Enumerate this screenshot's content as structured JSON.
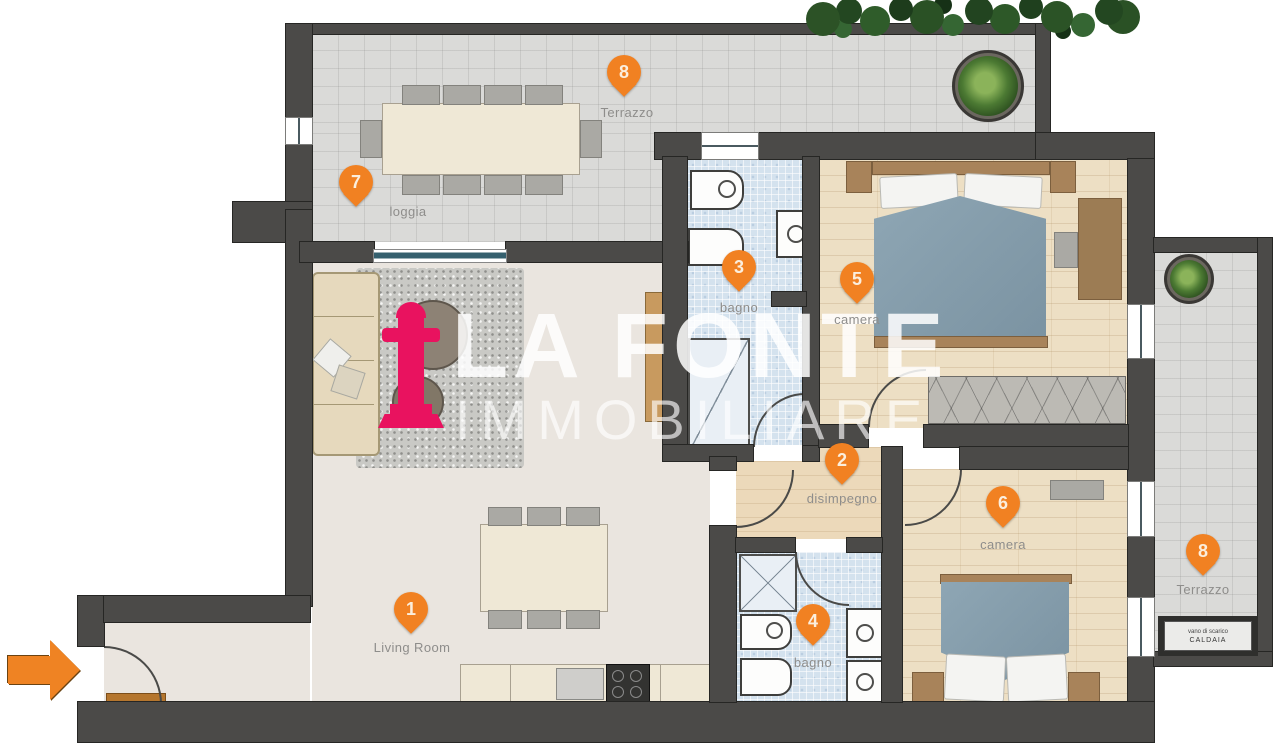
{
  "plan": {
    "brand": {
      "line1": "LA FONTE",
      "line2": "IMMOBILIARE"
    },
    "markers": [
      {
        "number": "1",
        "label": "Living Room"
      },
      {
        "number": "2",
        "label": "disimpegno"
      },
      {
        "number": "3",
        "label": "bagno"
      },
      {
        "number": "4",
        "label": "bagno"
      },
      {
        "number": "5",
        "label": "camera"
      },
      {
        "number": "6",
        "label": "camera"
      },
      {
        "number": "7",
        "label": "loggia"
      },
      {
        "number": "8",
        "label": "Terrazzo"
      },
      {
        "number": "8",
        "label": "Terrazzo"
      }
    ],
    "equipment_box": {
      "line1": "vano di scarico",
      "line2": "CALDAIA"
    },
    "colors": {
      "marker": "#f18122",
      "brand_pink": "#e9125f",
      "wall": "#4b4a48"
    }
  }
}
